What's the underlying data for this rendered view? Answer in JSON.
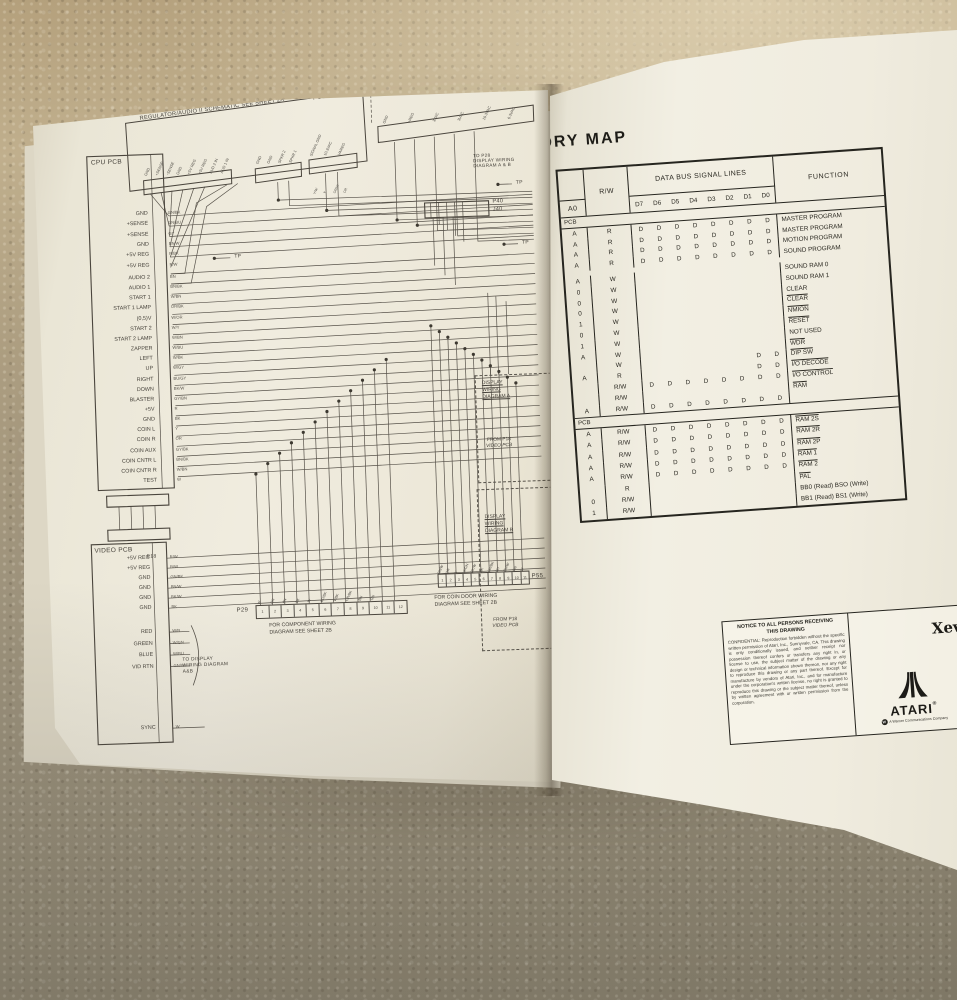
{
  "palette": {
    "page": "#f0ecdf",
    "carpet": "#ab9c7e",
    "schematic_line": "#57524a",
    "ink": "#26251f"
  },
  "left_page": {
    "header_box_label": "REGULATOR/AUDIO II SCHEMATIC  SEE SHEET 2A",
    "power_supply_label": "POWER SUPPLY WIRING DIA",
    "reg_conn_pins": [
      "GND",
      "+SENSE",
      "-SENSE",
      "GND",
      "+5V REG",
      "+5V REG",
      "AUD 2 IN",
      "AUD 1 IN"
    ],
    "p6_pins": [
      "GND",
      "GND",
      "SPKR 2",
      "SPKR 1"
    ],
    "p5_pins": [
      "SIGNAL GND",
      "10.3VAC",
      "VAREG"
    ],
    "p5_wires": [
      "Y/W",
      "Y",
      "OR/W",
      "OR"
    ],
    "power_pins": [
      "GND",
      "+REG",
      "3VAC",
      "3VAC",
      "10.3VAC",
      "6.3VAC"
    ],
    "cpu_pcb": {
      "title": "CPU PCB",
      "pins_top": [
        {
          "l": "GND",
          "w": "GN/BK"
        },
        {
          "l": "+SENSE",
          "w": "GN/BU"
        },
        {
          "l": "+SENSE",
          "w": "GY"
        },
        {
          "l": "GND",
          "w": "BN/W"
        },
        {
          "l": "+5V REG",
          "w": "R/BK"
        },
        {
          "l": "+5V REG",
          "w": "R/W"
        }
      ],
      "pins_main": [
        {
          "l": "AUDIO 2",
          "w": "BN"
        },
        {
          "l": "AUDIO 1",
          "w": "BN/BK"
        },
        {
          "l": "START 1",
          "w": "W/BN"
        },
        {
          "l": "START 1 LAMP",
          "w": "OR/BK"
        },
        {
          "l": "(0,5)V",
          "w": "W/OR"
        },
        {
          "l": "START 2",
          "w": "W/Y"
        },
        {
          "l": "START 2 LAMP",
          "w": "W/BN"
        },
        {
          "l": "ZAPPER",
          "w": "W/BU"
        },
        {
          "l": "LEFT",
          "w": "W/BK"
        },
        {
          "l": "UP",
          "w": "W/GY"
        },
        {
          "l": "RIGHT",
          "w": "BU/GY"
        },
        {
          "l": "DOWN",
          "w": "BK/W"
        },
        {
          "l": "BLASTER",
          "w": "GY/BN"
        },
        {
          "l": "+5V",
          "w": "R"
        },
        {
          "l": "GND",
          "w": "BK"
        },
        {
          "l": "COIN L",
          "w": "Y"
        },
        {
          "l": "COIN R",
          "w": "OR"
        },
        {
          "l": "COIN AUX",
          "w": "GY/BK"
        },
        {
          "l": "COIN CNTR L",
          "w": "BN/BK"
        },
        {
          "l": "COIN CNTR R",
          "w": "W/BN"
        },
        {
          "l": "TEST",
          "w": "W"
        }
      ]
    },
    "video_pcb": {
      "title": "VIDEO PCB",
      "connector": "P18",
      "pins_pwr": [
        {
          "l": "+5V REG",
          "w": "R/W"
        },
        {
          "l": "+5V REG",
          "w": "R/W"
        },
        {
          "l": "GND",
          "w": "GN/BK"
        },
        {
          "l": "GND",
          "w": "BN/W"
        },
        {
          "l": "GND",
          "w": "BK/W"
        },
        {
          "l": "GND",
          "w": "BK"
        }
      ],
      "pins_rgb": [
        {
          "l": "RED",
          "w": "W/R"
        },
        {
          "l": "GREEN",
          "w": "W/GN"
        },
        {
          "l": "BLUE",
          "w": "W/BU"
        },
        {
          "l": "VID RTN",
          "w": "GN/W"
        }
      ],
      "pin_sync": {
        "l": "SYNC",
        "w": "W"
      }
    },
    "labels": {
      "tp": "TP",
      "p40": "P40",
      "j40": "J40",
      "to_p28_l1": "TO P28",
      "to_p28_l2": "DISPLAY WIRING",
      "to_p28_l3": "DIAGRAM A & B",
      "p29": "P29",
      "p55": "P55",
      "p29_note1": "FOR COMPONENT WIRING",
      "p29_note2": "DIAGRAM SEE SHEET 2B",
      "p55_note1": "FOR COIN DOOR WIRING",
      "p55_note2": "DIAGRAM SEE SHEET 2B",
      "to_display": "TO DISPLAY WIRING DIAGRAM A&B",
      "disp_a_l1": "DISPLAY",
      "disp_a_l2": "WIRING",
      "disp_a_l3": "DIAGRAM A",
      "disp_b_l1": "DISPLAY",
      "disp_b_l2": "WIRING",
      "disp_b_l3": "DIAGRAM B",
      "from_p18_l1": "FROM P18",
      "from_p18_l2": "VIDEO PCB"
    },
    "p29_pin_numbers": [
      "1",
      "2",
      "3",
      "4",
      "5",
      "6",
      "7",
      "8",
      "9",
      "10",
      "11",
      "12"
    ],
    "p55_pin_numbers": [
      "1",
      "2",
      "3",
      "4",
      "5",
      "6",
      "7",
      "8",
      "9",
      "10",
      "11"
    ],
    "p29_wires": [
      "W",
      "OR",
      "BN",
      "BK",
      "W",
      "BU/BK",
      "V/BK",
      "OR/BK",
      "BN",
      "GN"
    ],
    "p55_wires": [
      "BN/W",
      "OR",
      "Y",
      "W/GN",
      "BK/W",
      "BK",
      "OR/BK",
      "BU",
      "BU/W",
      "GN",
      "W"
    ]
  },
  "right_page": {
    "title_visible": "ORY MAP",
    "table": {
      "col_addr": "A0",
      "col_rw": "R/W",
      "col_bus": "DATA BUS SIGNAL LINES",
      "col_func": "FUNCTION",
      "bus_bits": [
        "D7",
        "D6",
        "D5",
        "D4",
        "D3",
        "D2",
        "D1",
        "D0"
      ],
      "section1_label": "PCB",
      "section2_label": "PCB",
      "section1_rows": [
        {
          "a": "A",
          "rw": "R",
          "d": "DDDDDDDD",
          "fn": "MASTER PROGRAM",
          "ov": false
        },
        {
          "a": "A",
          "rw": "R",
          "d": "DDDDDDDD",
          "fn": "MASTER PROGRAM",
          "ov": false
        },
        {
          "a": "A",
          "rw": "R",
          "d": "DDDDDDDD",
          "fn": "MOTION PROGRAM",
          "ov": false
        },
        {
          "a": "A",
          "rw": "R",
          "d": "DDDDDDDD",
          "fn": "SOUND PROGRAM",
          "ov": false
        },
        {
          "a": "A",
          "rw": "W",
          "d": "........",
          "fn": "SOUND RAM 0",
          "ov": false,
          "gap": true
        },
        {
          "a": "0",
          "rw": "W",
          "d": "........",
          "fn": "SOUND RAM 1",
          "ov": false
        },
        {
          "a": "0",
          "rw": "W",
          "d": "........",
          "fn": "CLEAR",
          "ov": false
        },
        {
          "a": "0",
          "rw": "W",
          "d": "........",
          "fn": "CLEAR",
          "ov": true
        },
        {
          "a": "1",
          "rw": "W",
          "d": "........",
          "fn": "NMION",
          "ov": true
        },
        {
          "a": "0",
          "rw": "W",
          "d": "........",
          "fn": "RESET",
          "ov": true
        },
        {
          "a": "1",
          "rw": "W",
          "d": "........",
          "fn": "NOT USED",
          "ov": false
        },
        {
          "a": "A",
          "rw": "W",
          "d": "........",
          "fn": "WDR",
          "ov": true
        },
        {
          "a": "",
          "rw": "W",
          "d": "......DD",
          "fn": "DIP SW",
          "ov": true
        },
        {
          "a": "A",
          "rw": "R",
          "d": "......DD",
          "fn": "I/O DECODE",
          "ov": true
        },
        {
          "a": "",
          "rw": "R/W",
          "d": "DDDDDDDD",
          "fn": "I/O CONTROL",
          "ov": true
        },
        {
          "a": "",
          "rw": "R/W",
          "d": "........",
          "fn": "RAM",
          "ov": true
        },
        {
          "a": "A",
          "rw": "R/W",
          "d": "DDDDDDDD",
          "fn": "",
          "ov": false
        }
      ],
      "section2_rows": [
        {
          "a": "A",
          "rw": "R/W",
          "d": "DDDDDDDD",
          "fn": "RAM 2S",
          "ov": true
        },
        {
          "a": "A",
          "rw": "R/W",
          "d": "DDDDDDDD",
          "fn": "RAM 2R",
          "ov": true
        },
        {
          "a": "A",
          "rw": "R/W",
          "d": "DDDDDDDD",
          "fn": "RAM 2P",
          "ov": true
        },
        {
          "a": "A",
          "rw": "R/W",
          "d": "DDDDDDDD",
          "fn": "RAM 1",
          "ov": true
        },
        {
          "a": "A",
          "rw": "R/W",
          "d": "DDDDDDDD",
          "fn": "RAM 2",
          "ov": true
        },
        {
          "a": "",
          "rw": "R",
          "d": "........",
          "fn": "PAL",
          "ov": true
        },
        {
          "a": "0",
          "rw": "R/W",
          "d": "........",
          "fn": "BB0 (Read) BSO (Write)",
          "ov": false
        },
        {
          "a": "1",
          "rw": "R/W",
          "d": "........",
          "fn": "BB1 (Read) BS1 (Write)",
          "ov": false
        }
      ]
    },
    "notice": {
      "title_l1": "NOTICE TO ALL PERSONS RECEIVING",
      "title_l2": "THIS DRAWING",
      "body": "CONFIDENTIAL: Reproduction forbidden without the specific written permission of Atari, Inc., Sunnyvale, CA. This drawing is only conditionally issued, and neither receipt nor possession thereof confers or transfers any right in, or license to use, the subject matter of the drawing or any design or technical information shown thereon, nor any right to reproduce this drawing or any part thereof. Except for manufacture by vendors of Atari, Inc., and for manufacture under the corporation's written license, no right is granted to reproduce this drawing or the subject matter thereof, unless by written agreement with or written permission from the corporation."
    },
    "brand": {
      "game_title": "Xevi",
      "atari": "ATARI",
      "reg": "®",
      "warner": "A Warner Communications Company",
      "w_badge": "W"
    }
  }
}
